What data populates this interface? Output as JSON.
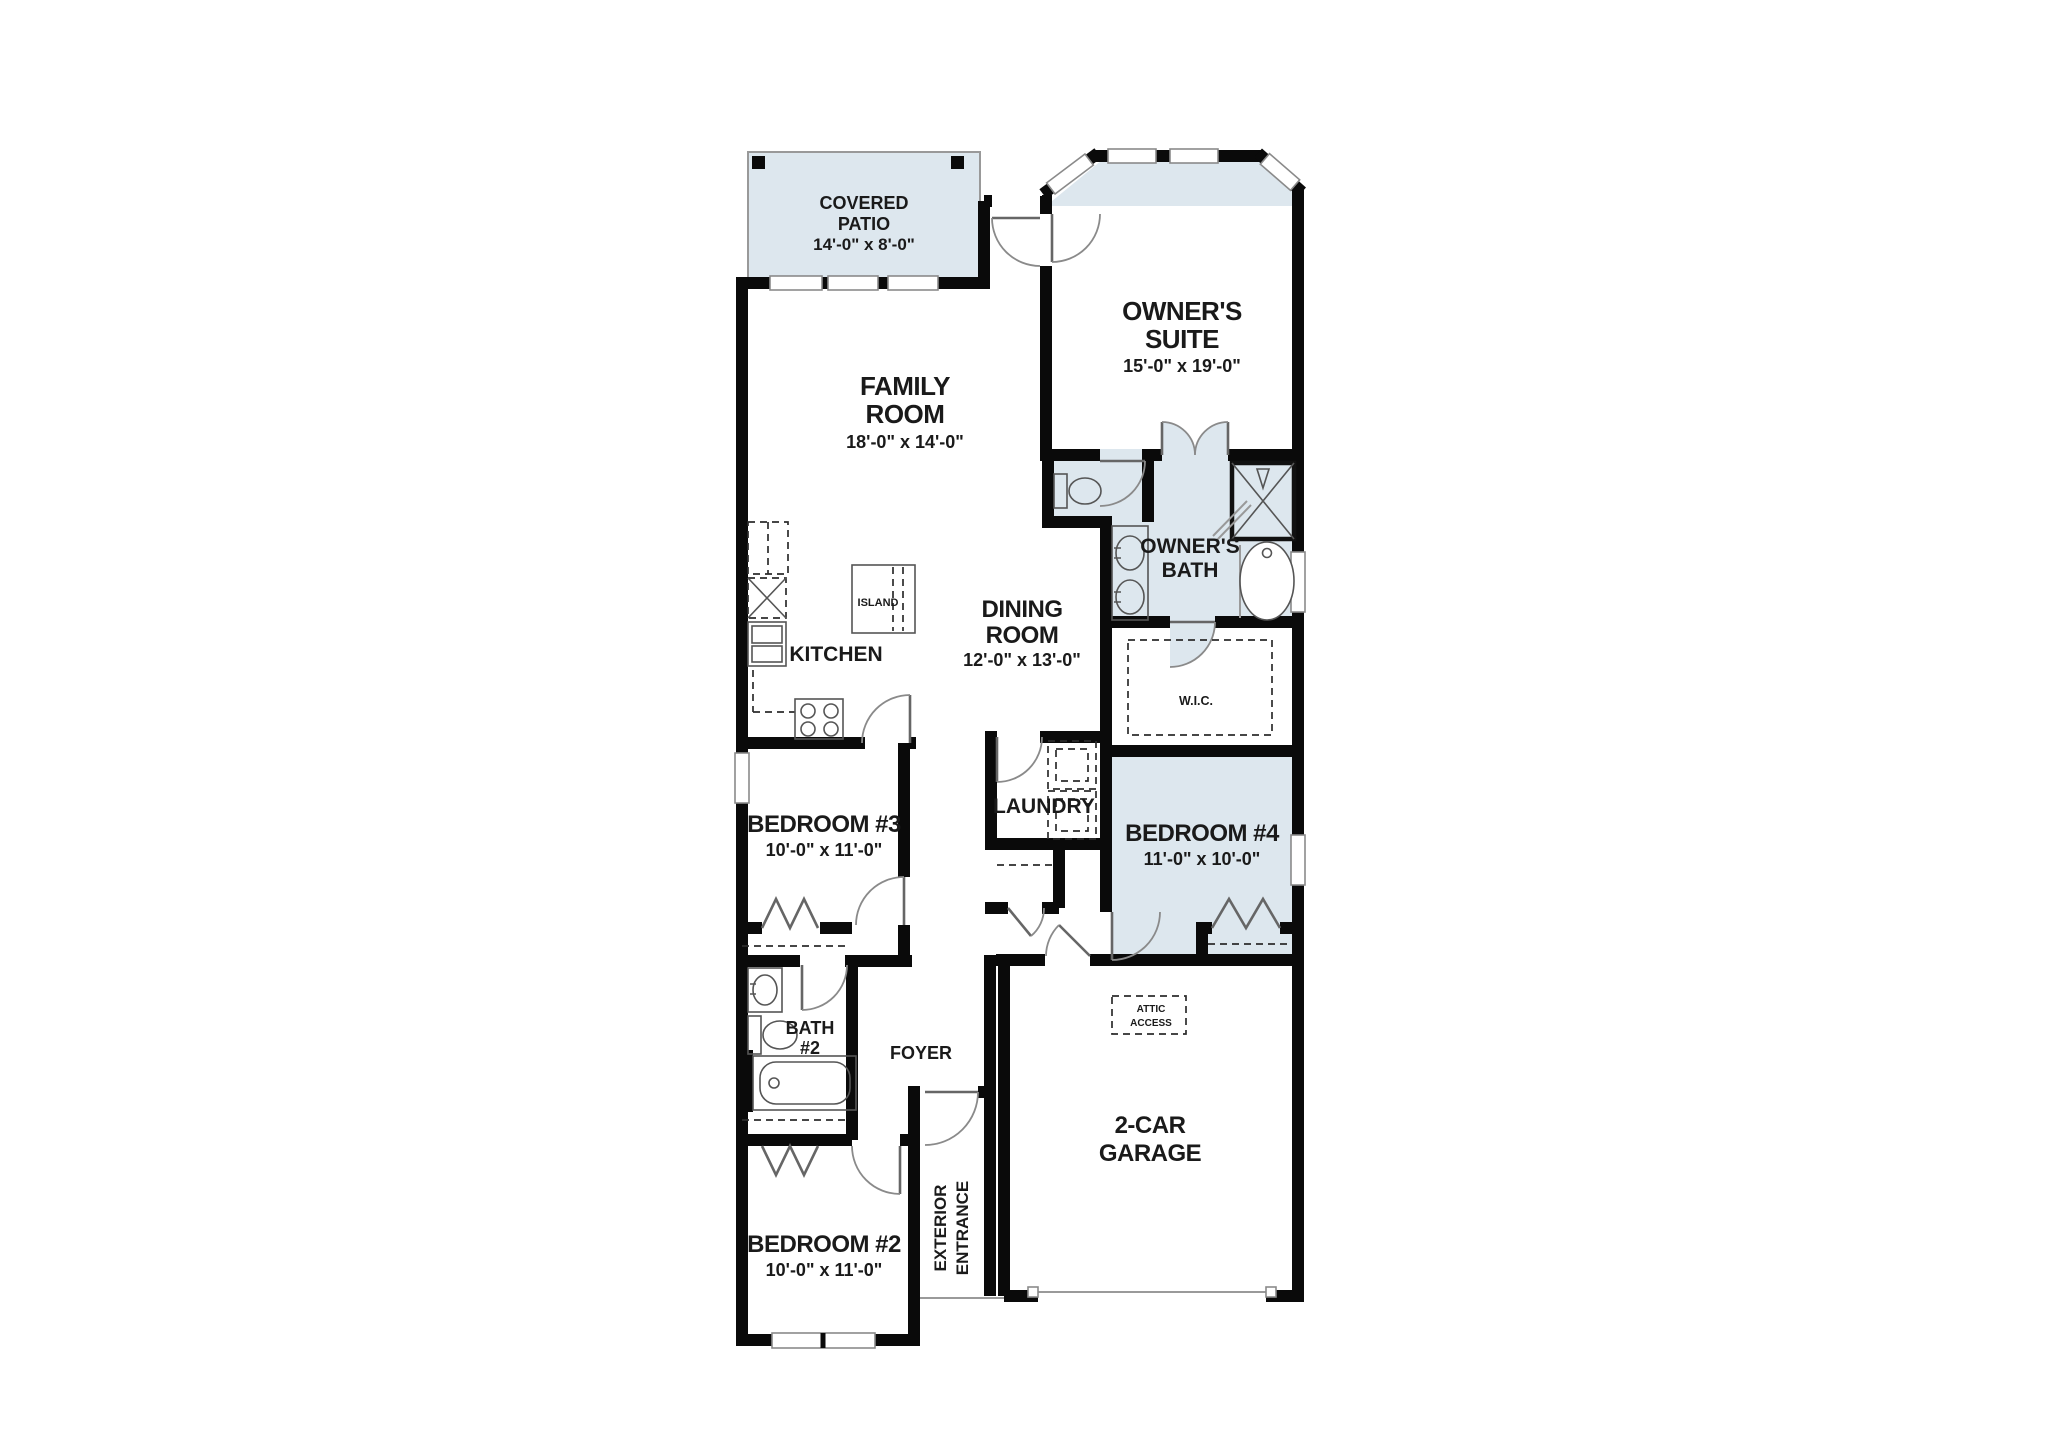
{
  "plan": {
    "title": "single-story house floor plan",
    "colors": {
      "shaded_floor": "#dde7ee",
      "wall": "#0a0a0a",
      "background": "#ffffff"
    },
    "rooms": {
      "covered_patio": {
        "line1": "COVERED",
        "line2": "PATIO",
        "dims": "14'-0\" x 8'-0\""
      },
      "family_room": {
        "line1": "FAMILY",
        "line2": "ROOM",
        "dims": "18'-0\" x 14'-0\""
      },
      "owners_suite": {
        "line1": "OWNER'S",
        "line2": "SUITE",
        "dims": "15'-0\" x 19'-0\""
      },
      "kitchen": {
        "line1": "KITCHEN"
      },
      "island": {
        "line1": "ISLAND"
      },
      "dining_room": {
        "line1": "DINING",
        "line2": "ROOM",
        "dims": "12'-0\" x 13'-0\""
      },
      "owners_bath": {
        "line1": "OWNER'S",
        "line2": "BATH"
      },
      "wic": {
        "line1": "W.I.C."
      },
      "laundry": {
        "line1": "LAUNDRY"
      },
      "bedroom3": {
        "line1": "BEDROOM #3",
        "dims": "10'-0\" x 11'-0\""
      },
      "bedroom4": {
        "line1": "BEDROOM #4",
        "dims": "11'-0\" x 10'-0\""
      },
      "bath2": {
        "line1": "BATH",
        "line2": "#2"
      },
      "foyer": {
        "line1": "FOYER"
      },
      "bedroom2": {
        "line1": "BEDROOM #2",
        "dims": "10'-0\" x 11'-0\""
      },
      "exterior_entrance": {
        "line1": "EXTERIOR",
        "line2": "ENTRANCE"
      },
      "garage": {
        "line1": "2-CAR",
        "line2": "GARAGE"
      },
      "attic_access": {
        "line1": "ATTIC",
        "line2": "ACCESS"
      }
    }
  }
}
